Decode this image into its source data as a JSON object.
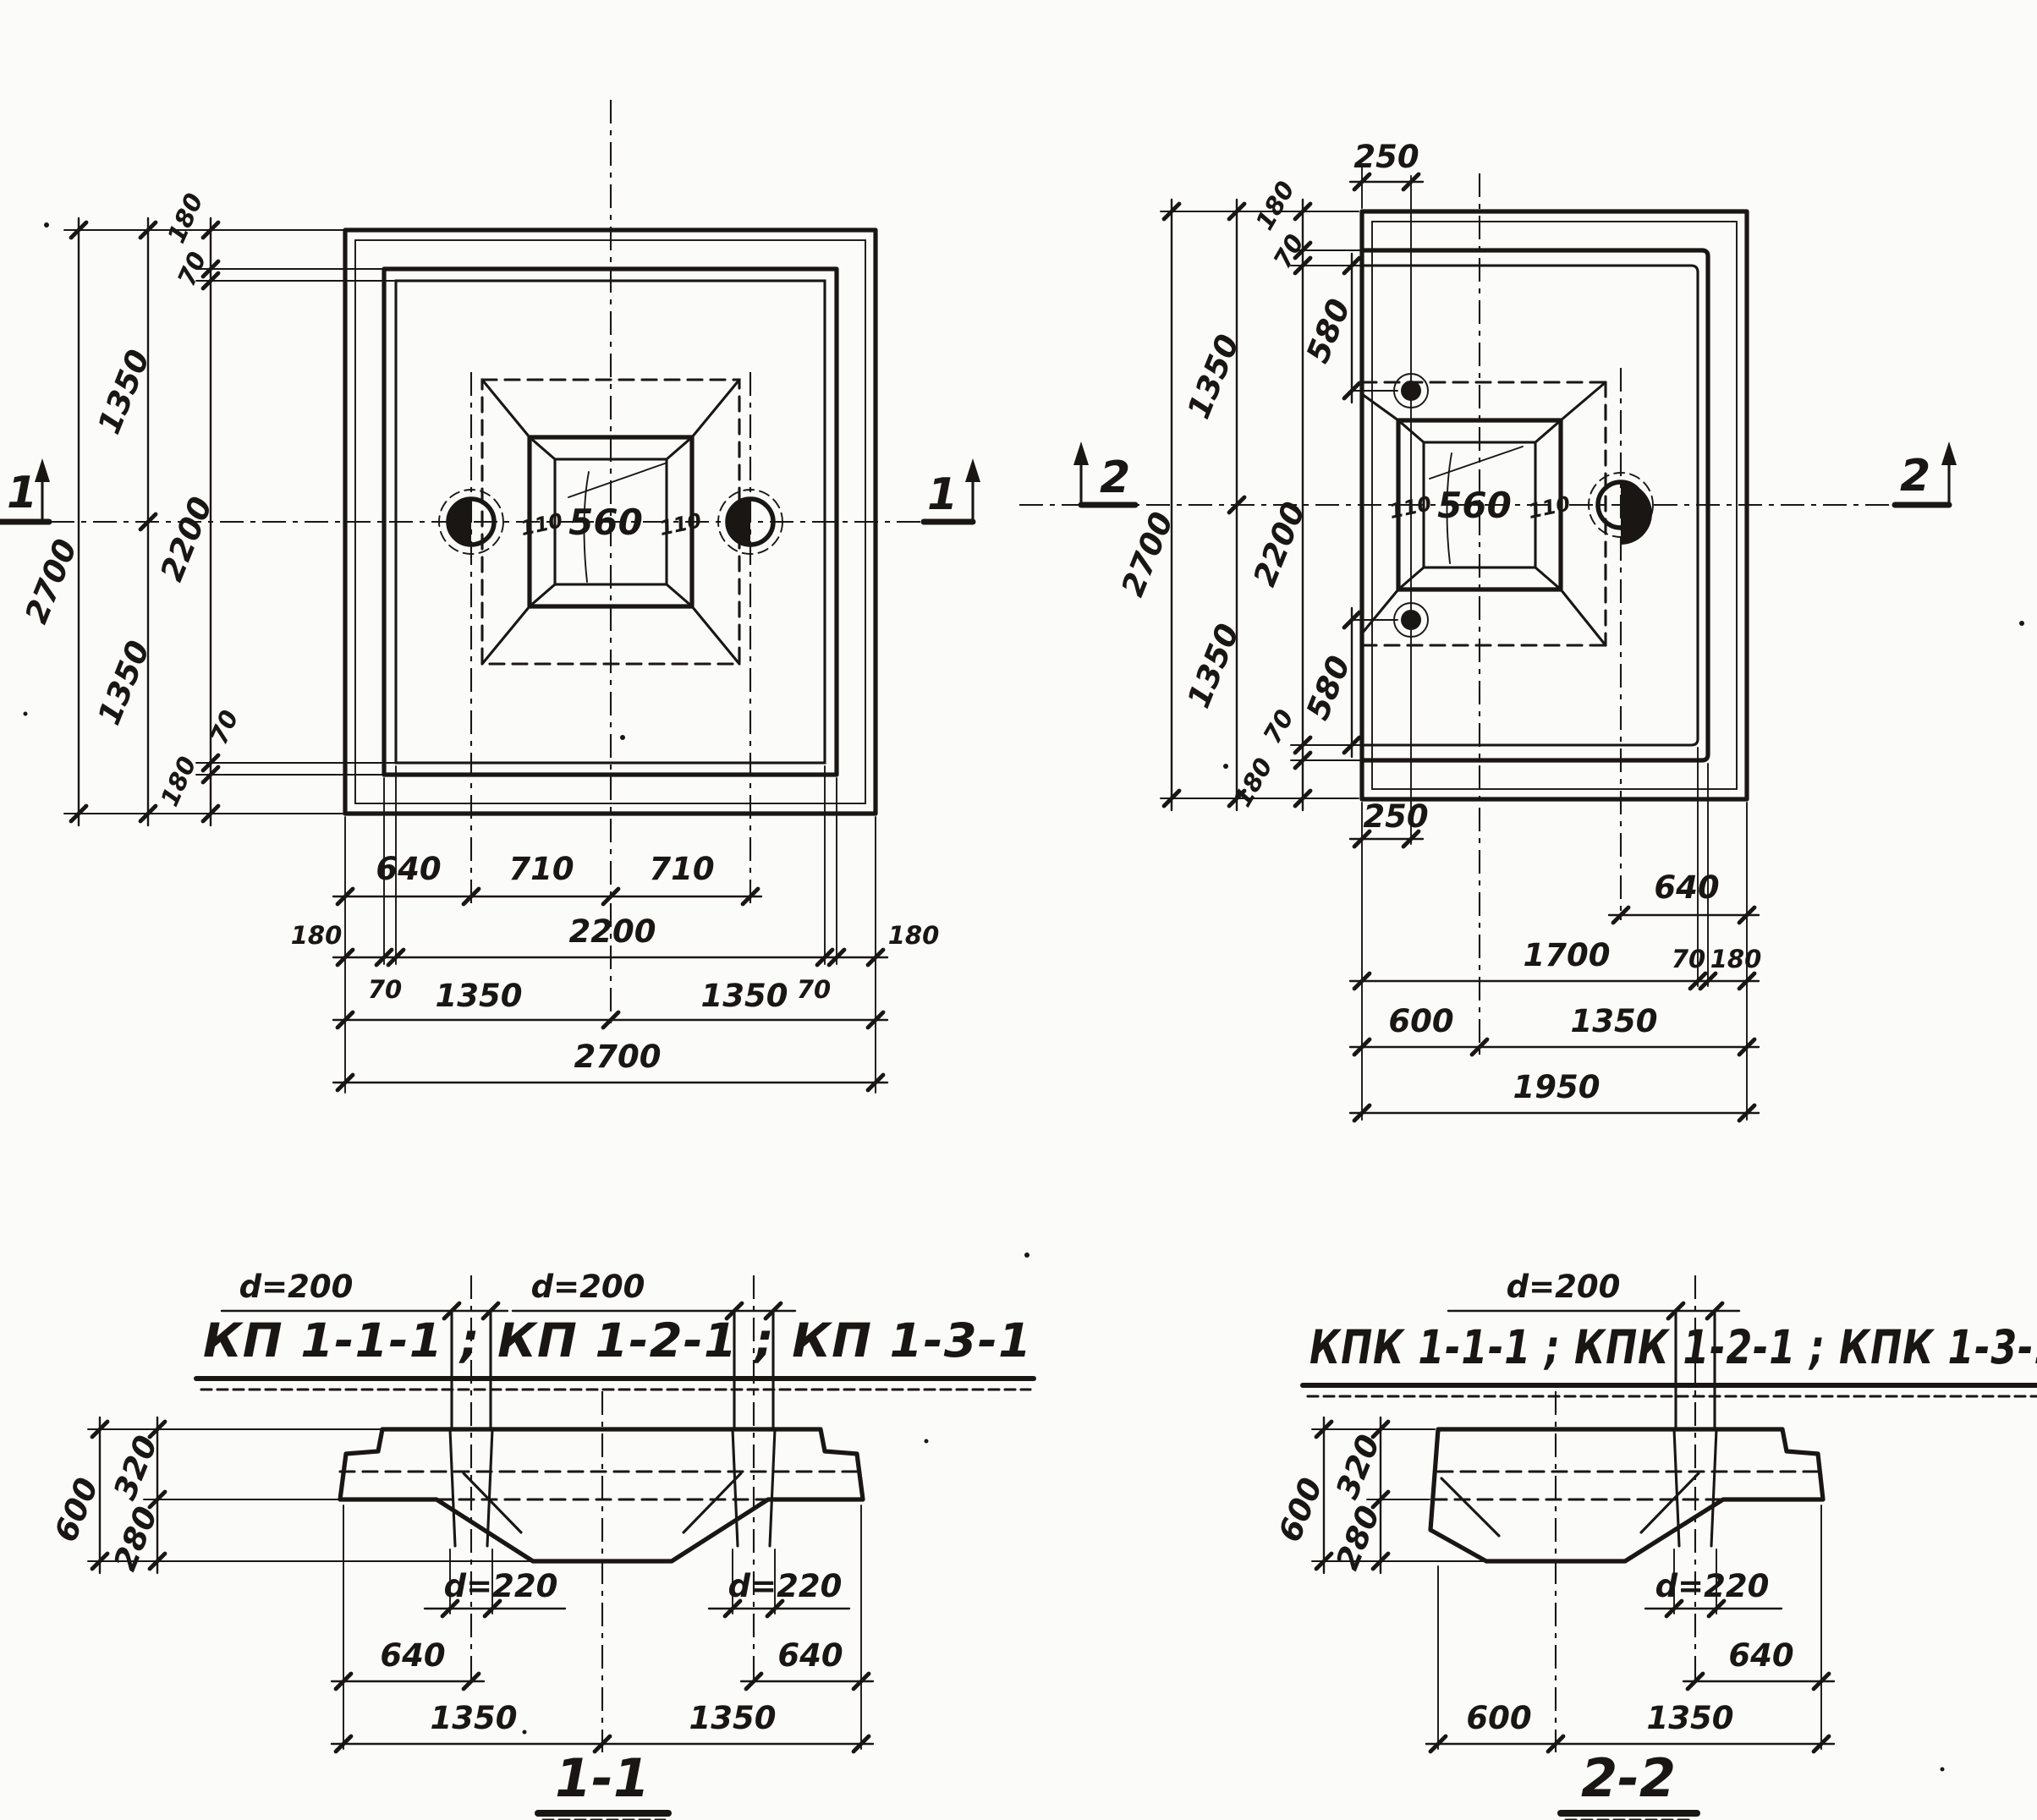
{
  "colors": {
    "ink": "#1a1613",
    "paper": "#fbfbf9"
  },
  "titles": {
    "left_codes": "КП 1-1-1 ; КП 1-2-1 ; КП 1-3-1",
    "right_codes": "КПК 1-1-1 ; КПК 1-2-1 ; КПК 1-3-1"
  },
  "left_plan": {
    "marker": "1",
    "side": {
      "edge_top": "180",
      "step_top": "70",
      "half_top": "1350",
      "total": "2700",
      "inner": "2200",
      "half_bottom": "1350",
      "step_bottom": "70",
      "edge_bottom": "180"
    },
    "bottom": {
      "hole_offset": "640",
      "hole_to_center_l": "710",
      "hole_to_center_r": "710",
      "edge_l": "180",
      "inner": "2200",
      "edge_r": "180",
      "step_l": "70",
      "step_r": "70",
      "half_l": "1350",
      "half_r": "1350",
      "total": "2700"
    },
    "socket": {
      "width": "560",
      "bevel_l": "110",
      "bevel_r": "110"
    }
  },
  "right_plan": {
    "marker": "2",
    "top_offset": "250",
    "bottom_offset": "250",
    "side": {
      "edge_top": "180",
      "step_top": "70",
      "loop_top": "580",
      "half_top": "1350",
      "total": "2700",
      "inner": "2200",
      "half_bottom": "1350",
      "step_bottom": "70",
      "loop_bottom": "580",
      "edge_bottom": "180"
    },
    "bottom": {
      "hole_offset": "640",
      "to_step": "1700",
      "step": "70",
      "edge": "180",
      "axis": "600",
      "span": "1350",
      "total": "1950"
    },
    "socket": {
      "width": "560",
      "bevel_l": "110",
      "bevel_r": "110"
    }
  },
  "sections": {
    "left": {
      "name": "1-1",
      "pipe_l": "d=200",
      "pipe_r": "d=200",
      "height": "600",
      "upper": "320",
      "lower": "280",
      "hole_l": "d=220",
      "hole_r": "d=220",
      "off_l": "640",
      "off_r": "640",
      "half_l": "1350",
      "half_r": "1350"
    },
    "right": {
      "name": "2-2",
      "pipe": "d=200",
      "height": "600",
      "upper": "320",
      "lower": "280",
      "hole": "d=220",
      "off": "640",
      "axis": "600",
      "span": "1350"
    }
  }
}
